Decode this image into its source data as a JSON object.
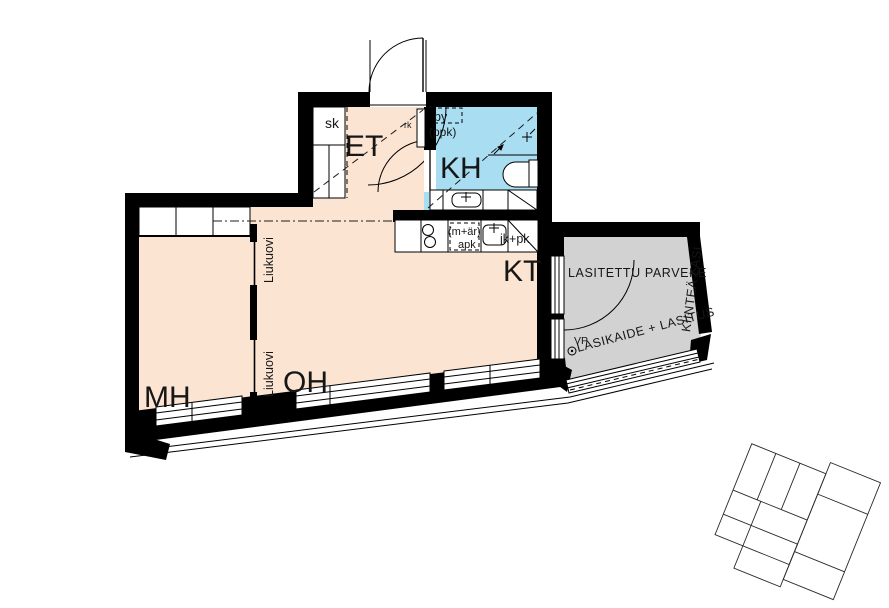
{
  "colors": {
    "wall": "#000000",
    "floor": "#fbe4d2",
    "bathroom": "#a9def2",
    "balcony": "#d2d2d2",
    "line": "#1c1c1c"
  },
  "rooms": {
    "bedroom": "MH",
    "living_room": "OH",
    "kitchen": "KT",
    "bathroom": "KH",
    "entrance_hall": "ET"
  },
  "labels": {
    "closet": "sk",
    "electrical_cabinet": "rk",
    "washer_place": "py",
    "washer_place_alt": "(ppk)",
    "kitchen_note": "(m+är)",
    "dishwasher": "apk",
    "fridge_freezer": "jk+pk",
    "sliding_door_upper": "Liukuovi",
    "sliding_door_lower": "Liukuovi",
    "glazed_balcony": "LASITETTU PARVEKE",
    "fixed_glass": "KIINTEÄ LASI",
    "glass_railing": "LASIKAIDE + LASITUS",
    "floor_drain": "VP"
  }
}
